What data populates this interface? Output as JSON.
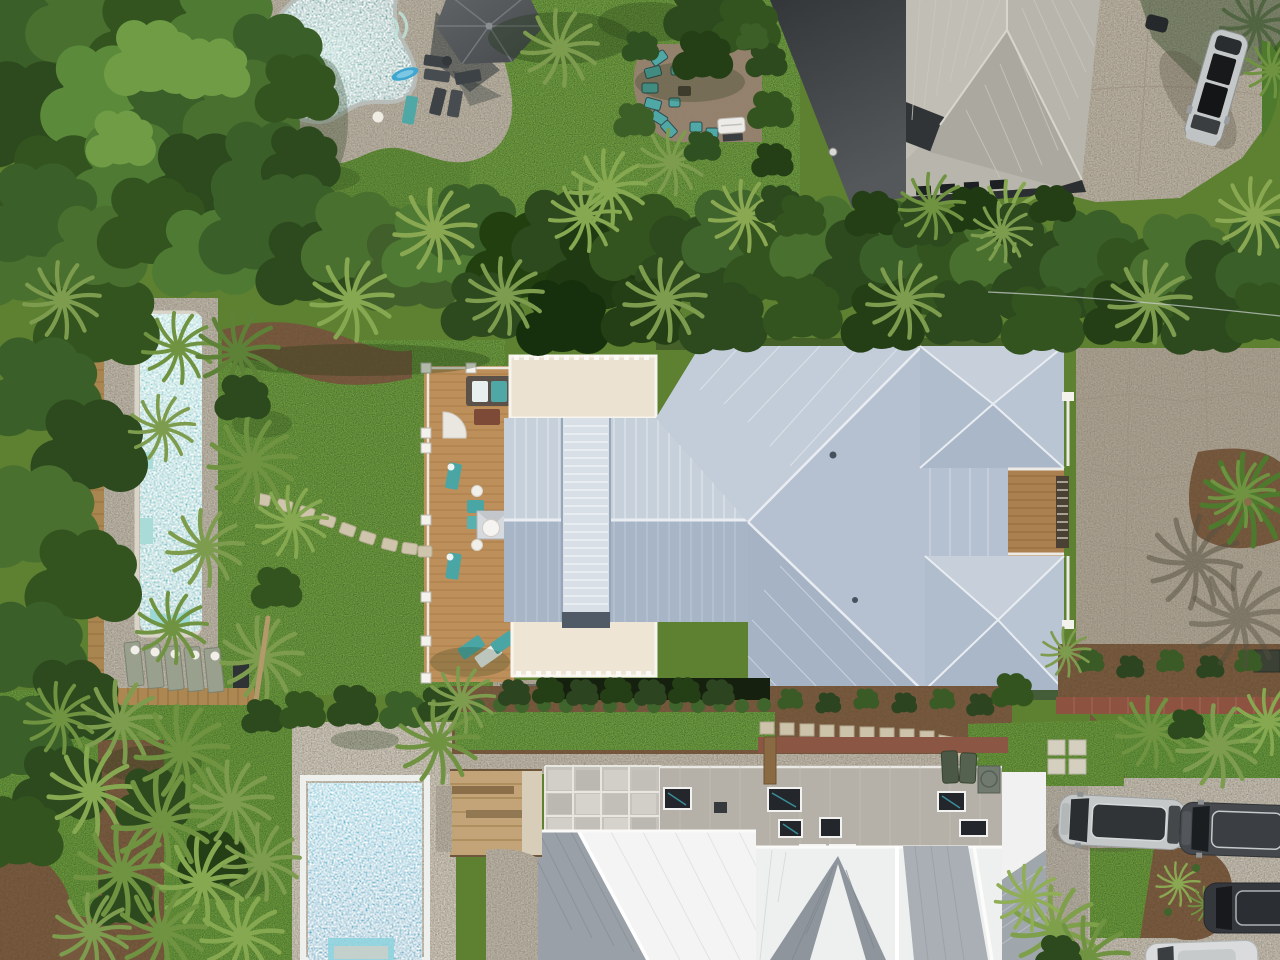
{
  "scene": {
    "type": "aerial-drone-photograph",
    "description": "Overhead drone view of three coastal residential lots: top-left yard with freeform pool and gazebo, top-right house with charcoal flat roof and warm-gray metal roof beside a driveway with a silver SUV, a central house with pale blue-gray standing-seam hip roof, cream flat roof wings, wood deck with teal loungers and a long lap pool among palmettos, and a bottom house with gray flat roof, skylights, white gabled metal roofs, rectangular blue pool and a driveway with parked vehicles",
    "lighting": "midday sun, hard shadows"
  },
  "palette": {
    "lawn_bright": "#82a744",
    "lawn_mid": "#74993a",
    "turf": "#7aa23c",
    "canopy_mid": "#4a7030",
    "mulch": "#6e5234",
    "kidney_pool_water": "#57a09b",
    "lap_pool_water": "#6cc4c6",
    "blue_pool_water": "#45b0cb",
    "pool_coping": "#b9bdb9",
    "coping_white": "#eef0ee",
    "pebble_deck": "#c3bcab",
    "stone_deck": "#d9d3c5",
    "gravel": "#c8c1b1",
    "concrete_warm": "#b3a996",
    "concrete_light": "#cdc7b9",
    "brick_path": "#8e5340",
    "wood_deck": "#bd8f5a",
    "wood_fence": "#a9854f",
    "metal_roof_light": "#c6d0da",
    "metal_roof_mid": "#b5c1d0",
    "metal_roof_dark": "#a7b5c6",
    "monitor_roof": "#d9dfe7",
    "cream_roof": "#ece2d2",
    "charcoal_roof": "#3b3f41",
    "warmgray_roof": "#b8b5ad",
    "flat_roof_gray": "#b5b1a8",
    "white_roof": "#f3f4f3",
    "roof_facet_gray": "#99a0a7",
    "teal_furniture": "#4fa8a6",
    "gazebo_roof": "#55595c",
    "car_silver": "#c5c8c9",
    "car_dark": "#45494d",
    "car_charcoal": "#34383c",
    "car_white": "#d9dbdc"
  },
  "objects": {
    "pools": [
      {
        "id": "kidney-pool",
        "shape": "freeform",
        "location": "top-left"
      },
      {
        "id": "lap-pool",
        "shape": "long narrow rectangle",
        "location": "left-middle"
      },
      {
        "id": "rect-pool",
        "shape": "rectangle",
        "location": "bottom-left"
      }
    ],
    "buildings": [
      {
        "id": "top-right-house",
        "roof": "charcoal flat roof + warm gray standing seam"
      },
      {
        "id": "center-house",
        "roof": "pale blue-gray standing-seam hips, cream flat wings, roof monitor, two pyramid hips, roof-deck recess"
      },
      {
        "id": "bottom-house",
        "roof": "gray flat roof with skylights + white standing-seam gables"
      }
    ],
    "vehicles": [
      {
        "id": "suv-top-right",
        "color": "silver",
        "location": "top-right driveway"
      },
      {
        "id": "suv-silver-bottom",
        "color": "silver",
        "location": "bottom driveway"
      },
      {
        "id": "suv-dark-bottom",
        "color": "dark gray",
        "location": "bottom driveway"
      },
      {
        "id": "suv-charcoal-bottom",
        "color": "charcoal",
        "location": "bottom right edge"
      },
      {
        "id": "car-white-bottom",
        "color": "white",
        "location": "bottom edge, partially visible"
      }
    ],
    "amenities": [
      "gazebo",
      "brick patio with teal sectional",
      "grill",
      "wood deck with teal loungers",
      "outdoor kitchen with dome",
      "stepping-stone paths",
      "lounge chair rows",
      "boardwalk",
      "palmetto garden bands",
      "trash bins",
      "driveway planting island",
      "power line"
    ]
  }
}
